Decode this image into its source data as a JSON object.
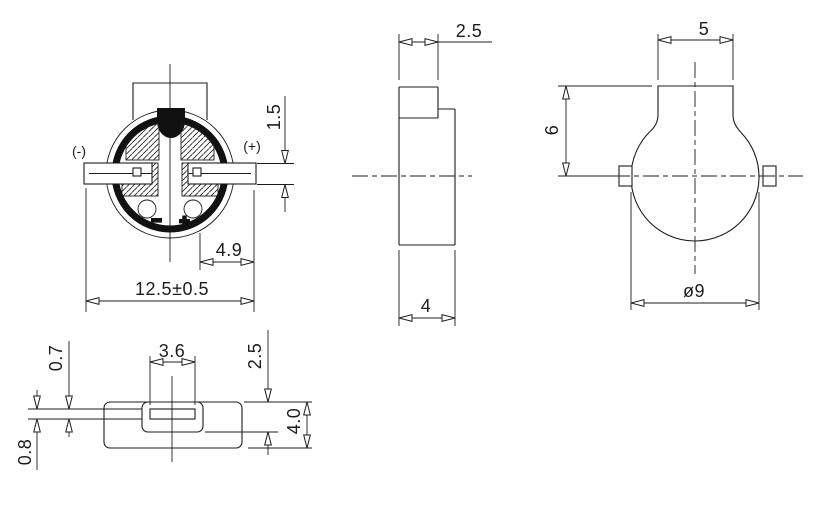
{
  "meta": {
    "background_color": "#ffffff",
    "line_color": "#1c1c1c",
    "drawing_type": "SMD buzzer mechanical drawing, four orthographic views"
  },
  "front_view": {
    "negative_label": "(-)",
    "positive_label": "(+)",
    "dim_terminal_thickness": "1.5",
    "dim_terminal_offset": "4.9",
    "dim_overall_width": "12.5±0.5"
  },
  "side_view": {
    "dim_tab_depth": "2.5",
    "dim_body_depth": "4"
  },
  "rear_view": {
    "dim_tab_width": "5",
    "dim_tab_height": "6",
    "dim_body_diameter": "ø9"
  },
  "bottom_view": {
    "dim_slot_width": "3.6",
    "dim_pad_thickness": "0.7",
    "dim_lead_thickness": "0.8",
    "dim_step_height": "2.5",
    "dim_body_height": "4.0"
  }
}
